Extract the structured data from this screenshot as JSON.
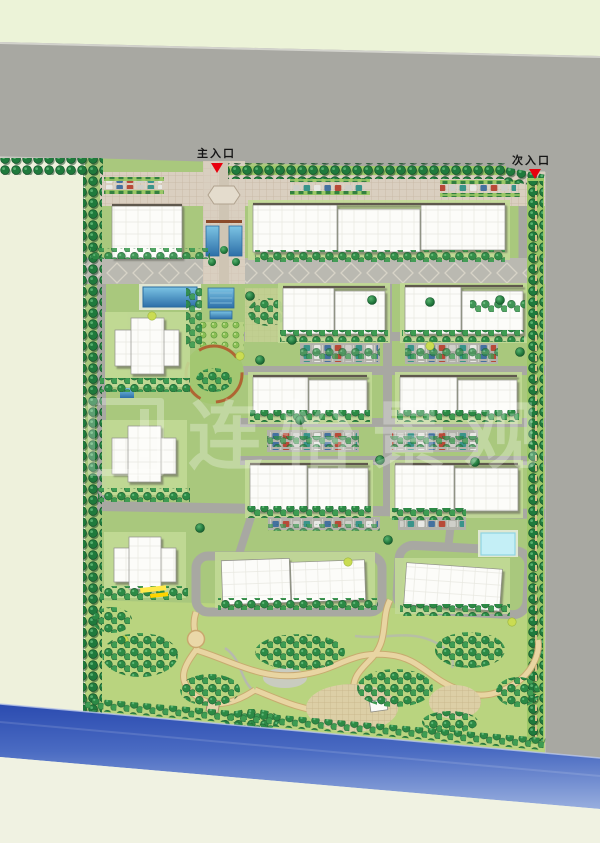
{
  "plan": {
    "kind": "residential community landscape master plan (top-down rendering)",
    "entrances": {
      "main": {
        "label": "主入口",
        "position": "top-center"
      },
      "secondary": {
        "label": "次入口",
        "position": "top-right"
      }
    },
    "watermark": {
      "text": "连怡景观"
    },
    "features": {
      "building_rows": 5,
      "point_towers_west": 3,
      "water": [
        "riverfront strip (south)",
        "lap pool",
        "entry-axis water channel",
        "cyan leisure pool"
      ],
      "parking": [
        "street-front parking lot (north)",
        "three internal parking strips with cars"
      ],
      "park": "large south garden with winding paths, tree groves and paved plazas"
    },
    "palette": {
      "background_cream": "#eef1dc",
      "top_field_green": "#ecf3d8",
      "road_gray": "#a8a8a2",
      "site_green": "#a9c87d",
      "park_lawn": "#b9d47f",
      "tree_dark_green": "#1f7a3c",
      "building_white": "#fcfcf9",
      "river_blue_dark": "#2b4bb0",
      "river_blue_light": "#98aede",
      "pool_blue": "#2d6fa8",
      "pool_cyan": "#c4eff6",
      "path_tan": "#e8d5a2",
      "marker_red": "#e8000d"
    }
  }
}
